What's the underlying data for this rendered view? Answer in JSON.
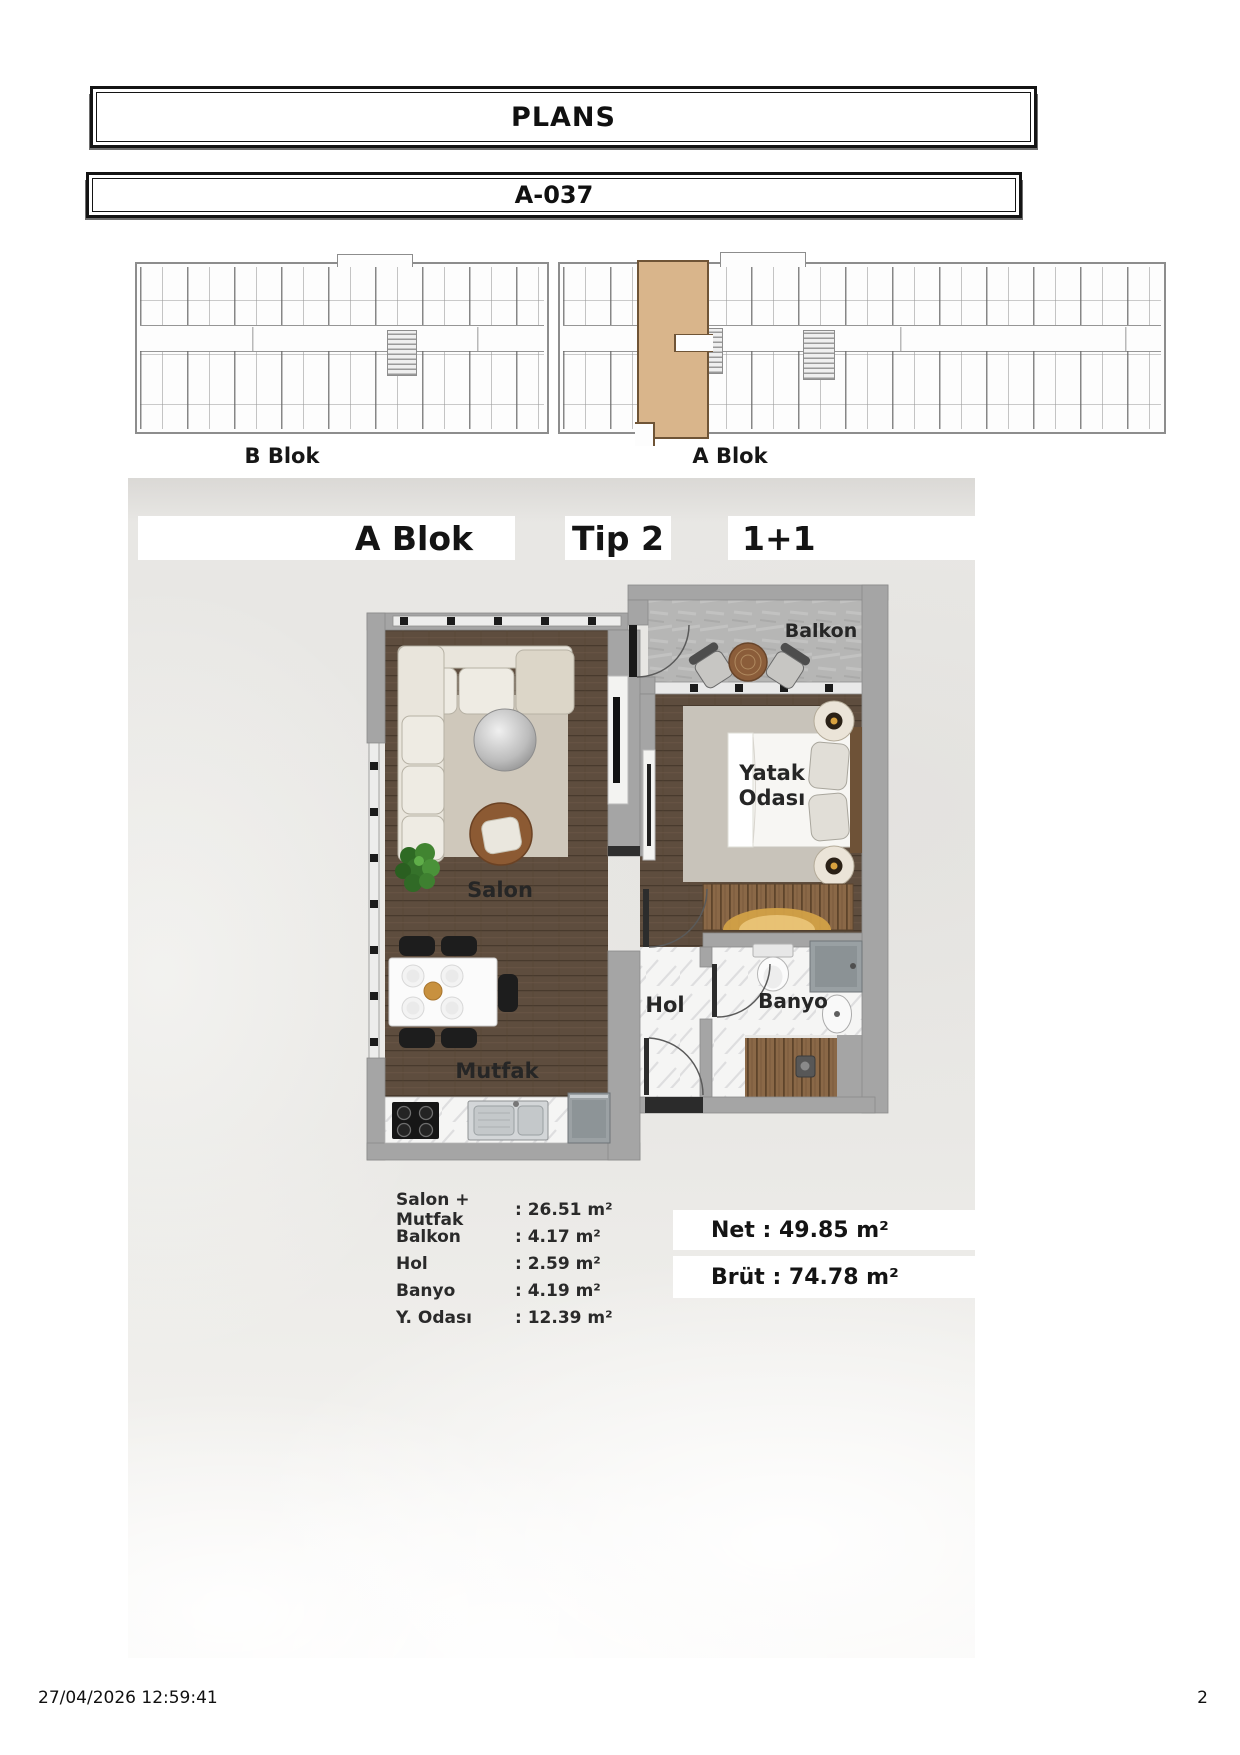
{
  "header": {
    "title": "PLANS",
    "code": "A-037"
  },
  "overview": {
    "b_label": "B Blok",
    "a_label": "A Blok",
    "highlight_color": "#d9b58b"
  },
  "unit": {
    "block": "A Blok",
    "type": "Tip 2",
    "layout": "1+1"
  },
  "plan": {
    "balkon": "Balkon",
    "yatak1": "Yatak",
    "yatak2": "Odası",
    "salon": "Salon",
    "mutfak": "Mutfak",
    "hol": "Hol",
    "banyo": "Banyo"
  },
  "areas": {
    "rows": [
      {
        "label": "Salon + Mutfak",
        "value": ": 26.51 m²"
      },
      {
        "label": "Balkon",
        "value": ": 4.17 m²"
      },
      {
        "label": "Hol",
        "value": ": 2.59 m²"
      },
      {
        "label": "Banyo",
        "value": ": 4.19 m²"
      },
      {
        "label": "Y. Odası",
        "value": ": 12.39 m²"
      }
    ],
    "net": "Net :  49.85 m²",
    "brut": "Brüt : 74.78 m²"
  },
  "footer": {
    "datetime": "27/04/2026 12:59:41",
    "page": "2"
  }
}
